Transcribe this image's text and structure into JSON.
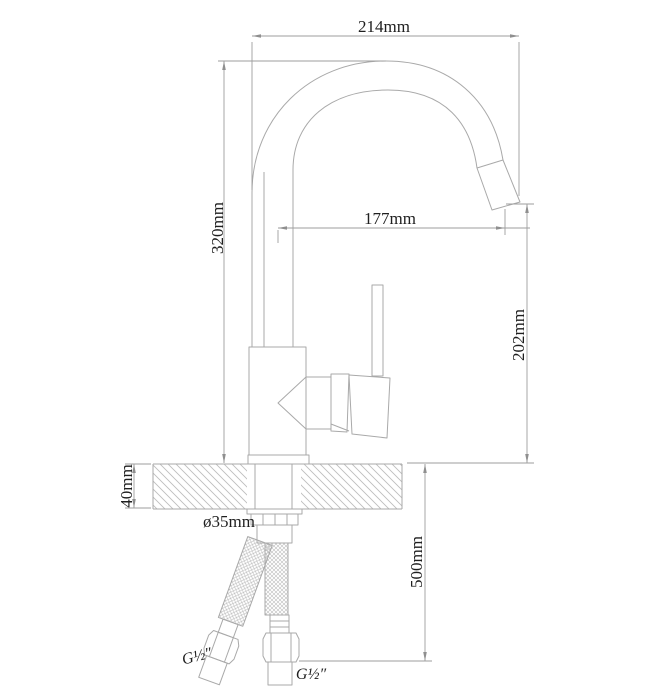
{
  "page": {
    "background": "#ffffff"
  },
  "diagram": {
    "kind": "faucet-installation-technical-drawing",
    "colors": {
      "line": "#a9a9a9",
      "dim": "#9e9e9e",
      "arrow": "#8f8f8f",
      "hatch": "#bdbdbd",
      "text": "#1f1f1f"
    },
    "labels": {
      "top_width": "214mm",
      "total_height": "320mm",
      "spout_reach": "177mm",
      "outlet_height": "202mm",
      "counter_thickness": "40mm",
      "hole_diameter": "ø35mm",
      "hose_length": "500mm",
      "left_hose_thread": "G½″",
      "right_hose_thread": "G½″"
    }
  }
}
